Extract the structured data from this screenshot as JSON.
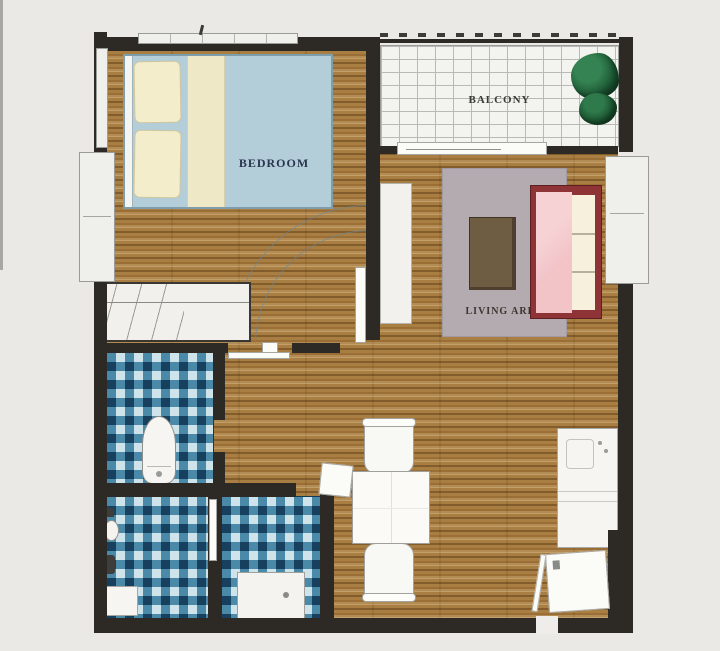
{
  "type": "apartment-floor-plan",
  "rooms": {
    "bedroom": {
      "label": "BEDROOM"
    },
    "balcony": {
      "label": "BALCONY"
    },
    "living_area": {
      "label": "LIVING AREA"
    }
  },
  "colors": {
    "wall": "#2d2a26",
    "wood_floor": "#a87e42",
    "bathroom_tile_mid": "#4a8aa8",
    "bathroom_tile_dark": "#16405e",
    "bathroom_tile_light": "#cfe4ea",
    "bed": "#b3cdd9",
    "pillow": "#f3edcb",
    "blanket": "#efe8c6",
    "rug": "#b4abb0",
    "sofa_frame": "#8e3436",
    "sofa_cushion": "#f2c4c8",
    "coffee_table": "#6e5d43",
    "plant": "#1d5a36",
    "balcony_tile": "#f3f3ef",
    "label_bedroom": "#2a3550",
    "label_balcony": "#3a3a36",
    "label_living": "#3c3530"
  }
}
